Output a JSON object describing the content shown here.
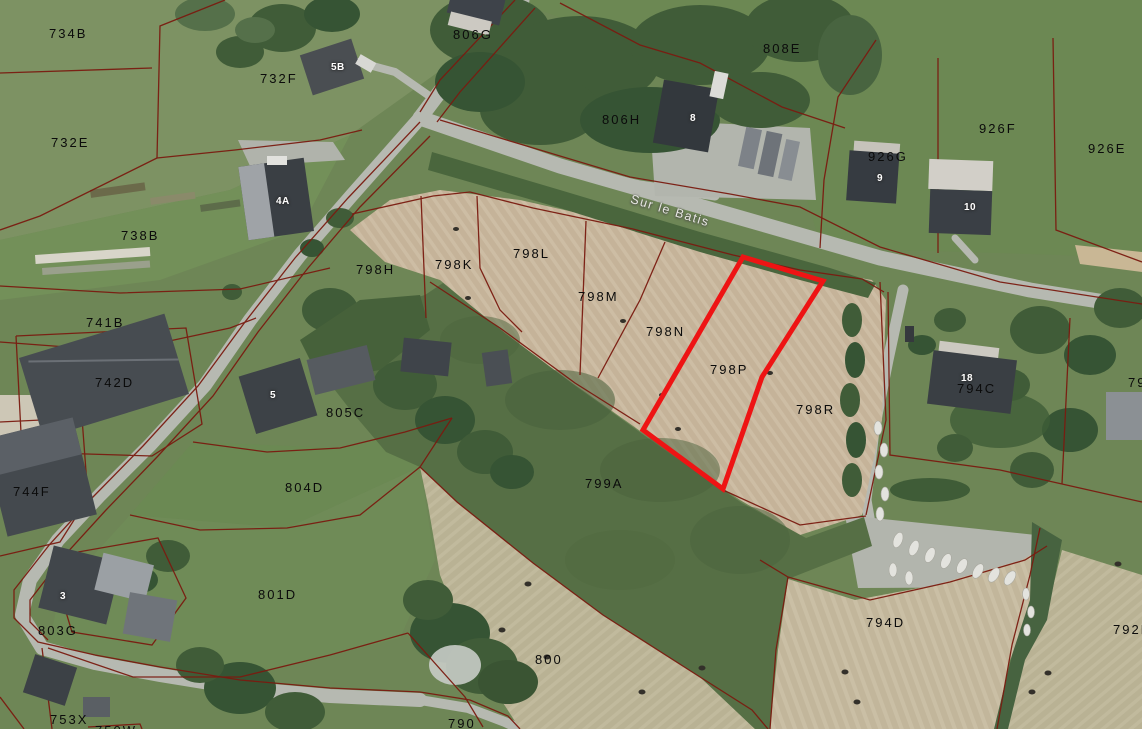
{
  "map": {
    "type": "cadastral-aerial-view",
    "street_label": {
      "text": "Sur le Batis",
      "x": 633,
      "y": 192,
      "rotation": 17
    },
    "highlight": {
      "parcel": "798P",
      "color": "#ee1414",
      "stroke_width": 5,
      "points": "743,257 823,281 762,377 723,489 643,430"
    },
    "colors": {
      "boundary_line": "#7a1b10",
      "highlight_red": "#ee1414",
      "field_tan": "#c5b399",
      "field_green": "#6e8656",
      "meadow_green": "#566f45",
      "tree_green": "#405c38",
      "road_gray": "#b6b9b1"
    },
    "parcel_labels": [
      {
        "text": "734B",
        "x": 49,
        "y": 26
      },
      {
        "text": "732E",
        "x": 51,
        "y": 135
      },
      {
        "text": "732F",
        "x": 260,
        "y": 71
      },
      {
        "text": "806G",
        "x": 453,
        "y": 27
      },
      {
        "text": "808E",
        "x": 763,
        "y": 41
      },
      {
        "text": "806H",
        "x": 602,
        "y": 112
      },
      {
        "text": "926F",
        "x": 979,
        "y": 121
      },
      {
        "text": "926E",
        "x": 1088,
        "y": 141
      },
      {
        "text": "926G",
        "x": 868,
        "y": 149
      },
      {
        "text": "738B",
        "x": 121,
        "y": 228
      },
      {
        "text": "798H",
        "x": 356,
        "y": 262
      },
      {
        "text": "798K",
        "x": 435,
        "y": 257
      },
      {
        "text": "798L",
        "x": 513,
        "y": 246
      },
      {
        "text": "798M",
        "x": 578,
        "y": 289
      },
      {
        "text": "798N",
        "x": 646,
        "y": 324
      },
      {
        "text": "798P",
        "x": 710,
        "y": 362
      },
      {
        "text": "798R",
        "x": 796,
        "y": 402
      },
      {
        "text": "741B",
        "x": 86,
        "y": 315
      },
      {
        "text": "742D",
        "x": 95,
        "y": 375
      },
      {
        "text": "805C",
        "x": 326,
        "y": 405
      },
      {
        "text": "794C",
        "x": 957,
        "y": 381
      },
      {
        "text": "79",
        "x": 1128,
        "y": 375
      },
      {
        "text": "804D",
        "x": 285,
        "y": 480
      },
      {
        "text": "744F",
        "x": 13,
        "y": 484
      },
      {
        "text": "799A",
        "x": 585,
        "y": 476
      },
      {
        "text": "801D",
        "x": 258,
        "y": 587
      },
      {
        "text": "803G",
        "x": 38,
        "y": 623
      },
      {
        "text": "800",
        "x": 535,
        "y": 652
      },
      {
        "text": "794D",
        "x": 866,
        "y": 615
      },
      {
        "text": "792F",
        "x": 1113,
        "y": 622
      },
      {
        "text": "753X",
        "x": 50,
        "y": 712
      },
      {
        "text": "790",
        "x": 448,
        "y": 716
      },
      {
        "text": "750W",
        "x": 95,
        "y": 723
      }
    ],
    "building_labels": [
      {
        "text": "5B",
        "x": 331,
        "y": 62
      },
      {
        "text": "8",
        "x": 690,
        "y": 113
      },
      {
        "text": "9",
        "x": 877,
        "y": 173
      },
      {
        "text": "10",
        "x": 964,
        "y": 202
      },
      {
        "text": "4A",
        "x": 276,
        "y": 196
      },
      {
        "text": "5",
        "x": 270,
        "y": 390
      },
      {
        "text": "3",
        "x": 60,
        "y": 591
      },
      {
        "text": "18",
        "x": 961,
        "y": 373
      }
    ]
  }
}
